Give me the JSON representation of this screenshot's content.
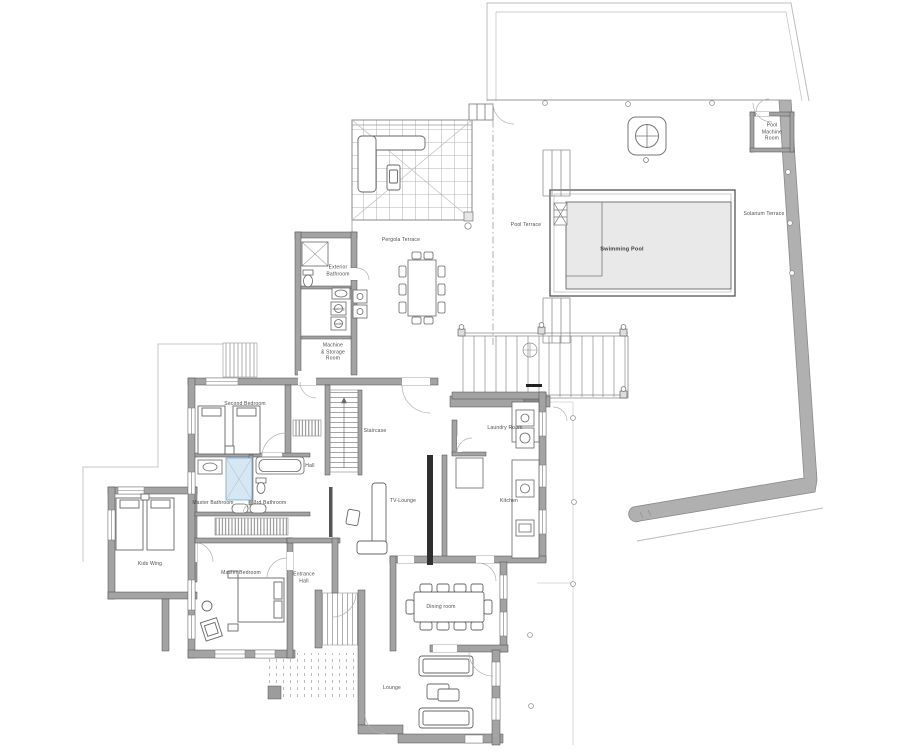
{
  "labels": {
    "second_bedroom": "Second Bedroom",
    "staircase": "Staircase",
    "hall": "Hall",
    "laundry_room": "Laundry Room",
    "kitchen": "Kitchen",
    "tv_lounge": "TV-Lounge",
    "master_bathroom": "Master Bathroom",
    "third_bathroom": "3rd Bathroom",
    "master_bedroom": "Master Bedroom",
    "entrance_hall": "Entrance\nHall",
    "kids_wing": "Kids Wing",
    "exterior_bathroom": "Exterior\nBathroom",
    "machine_storage_room": "Machine\n& Storage\nRoom",
    "pergola_terrace": "Pergola Terrace",
    "pool_terrace": "Pool Terrace",
    "swimming_pool": "Swimming Pool",
    "solarium_terrace": "Solarium Terrace",
    "pool_machine_room": "Pool\nMachine\nRoom",
    "dining_room": "Dining room",
    "lounge": "Lounge",
    "washing_machine": "washing",
    "boiler": "boiler"
  },
  "colors": {
    "background": "#ffffff",
    "wall_gray": "#a3a3a3",
    "wall_dark": "#2f2f2f",
    "pool_water": "#e9e9e9",
    "shower_blue": "#d6e7f4",
    "line_gray": "#8f8f8f",
    "boundary_gray": "#bcbcbc",
    "label_text": "#4a4a4a"
  }
}
